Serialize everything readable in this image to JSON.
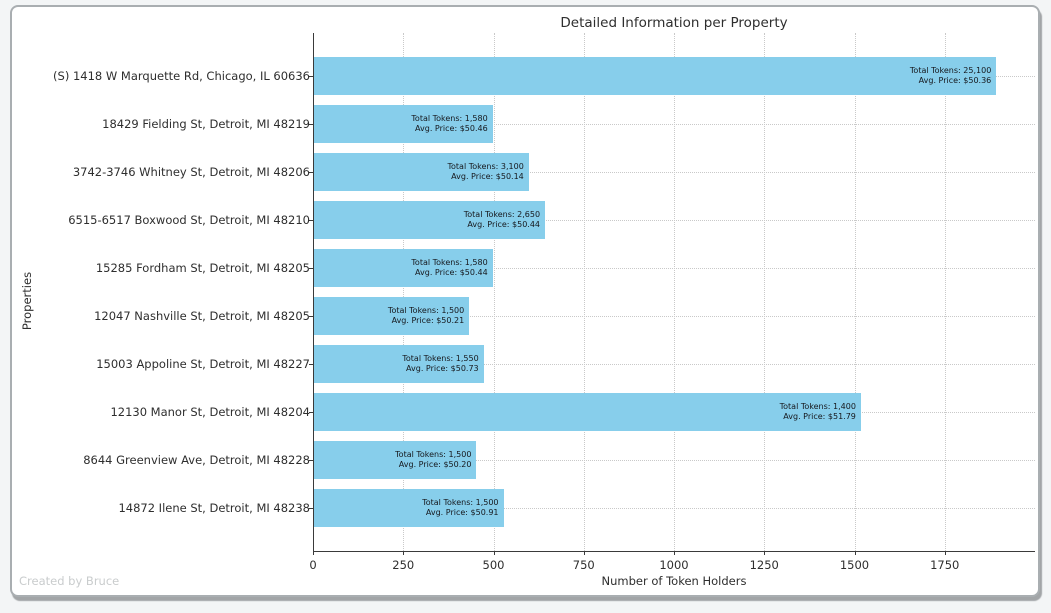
{
  "footer": {
    "watermark": "Created by Bruce"
  },
  "colors": {
    "bar": "#87CEEB",
    "grid": "#c9c9c9",
    "page_background": "#f3f5f6",
    "card_background": "#ffffff"
  },
  "chart_data": {
    "type": "bar",
    "orientation": "horizontal",
    "title": "Detailed Information per Property",
    "xlabel": "Number of Token Holders",
    "ylabel": "Properties",
    "xlim": [
      0,
      2000
    ],
    "xticks": [
      0,
      250,
      500,
      750,
      1000,
      1250,
      1500,
      1750
    ],
    "grid": true,
    "legend": false,
    "bar_color": "#87CEEB",
    "categories": [
      "(S) 1418 W Marquette Rd, Chicago, IL 60636",
      "18429 Fielding St, Detroit, MI 48219",
      "3742-3746 Whitney St, Detroit, MI 48206",
      "6515-6517 Boxwood St, Detroit, MI 48210",
      "15285 Fordham St, Detroit, MI 48205",
      "12047 Nashville St, Detroit, MI 48205",
      "15003 Appoline St, Detroit, MI 48227",
      "12130 Manor St, Detroit, MI 48204",
      "8644 Greenview Ave, Detroit, MI 48228",
      "14872 Ilene St, Detroit, MI 48238"
    ],
    "values": [
      1890,
      495,
      595,
      640,
      495,
      430,
      470,
      1515,
      450,
      525
    ],
    "annotations": [
      {
        "total": "Total Tokens: 25,100",
        "price": "Avg. Price: $50.36"
      },
      {
        "total": "Total Tokens: 1,580",
        "price": "Avg. Price: $50.46"
      },
      {
        "total": "Total Tokens: 3,100",
        "price": "Avg. Price: $50.14"
      },
      {
        "total": "Total Tokens: 2,650",
        "price": "Avg. Price: $50.44"
      },
      {
        "total": "Total Tokens: 1,580",
        "price": "Avg. Price: $50.44"
      },
      {
        "total": "Total Tokens: 1,500",
        "price": "Avg. Price: $50.21"
      },
      {
        "total": "Total Tokens: 1,550",
        "price": "Avg. Price: $50.73"
      },
      {
        "total": "Total Tokens: 1,400",
        "price": "Avg. Price: $51.79"
      },
      {
        "total": "Total Tokens: 1,500",
        "price": "Avg. Price: $50.20"
      },
      {
        "total": "Total Tokens: 1,500",
        "price": "Avg. Price: $50.91"
      }
    ]
  }
}
